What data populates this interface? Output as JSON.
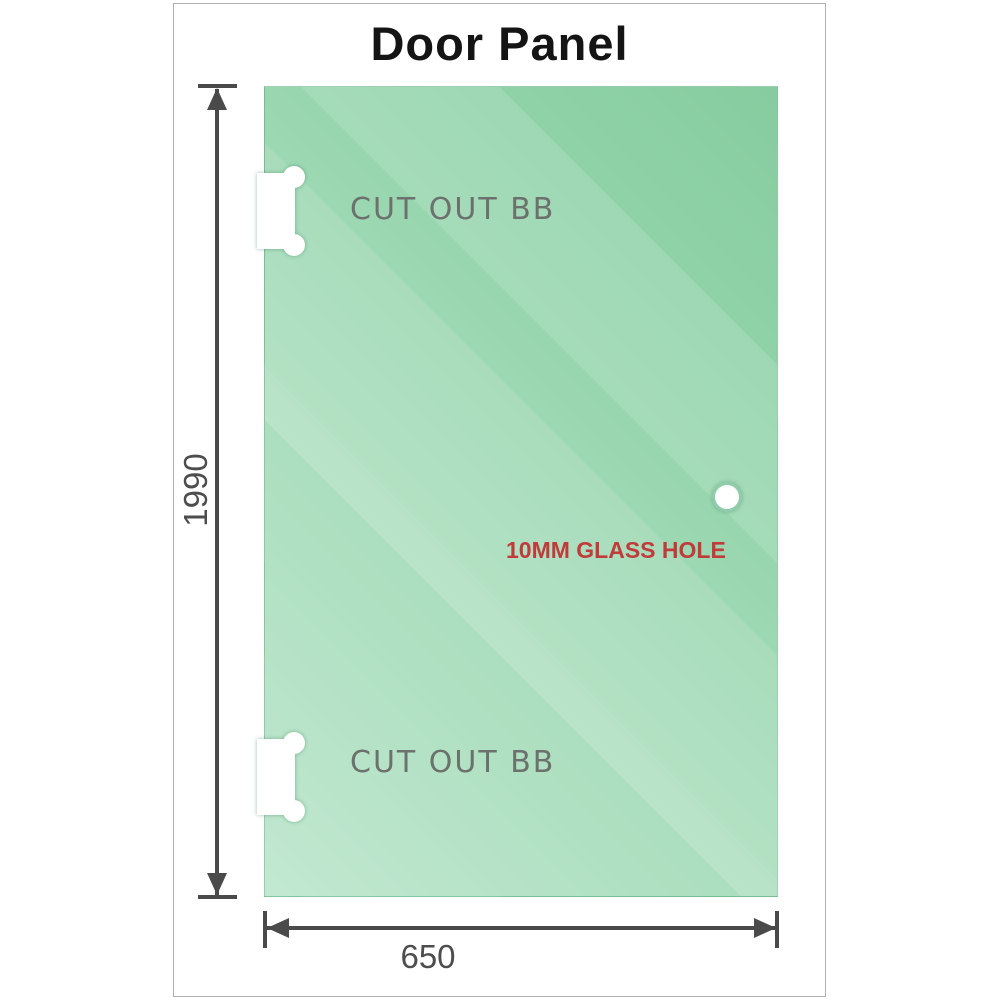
{
  "title": "Door Panel",
  "dim": {
    "height": "1990",
    "width": "650"
  },
  "labels": {
    "cutout_top": "CUT OUT BB",
    "cutout_bottom": "CUT OUT BB",
    "glass_hole": "10MM GLASS HOLE"
  },
  "icons": {
    "hinge_cutout": "white-notch-rect-with-two-round-lugs",
    "glass_hole": "white-circle-with-green-rim",
    "dimension_arrow": "css-triangle"
  },
  "colors": {
    "glass_light": "#c2e8d1",
    "glass_base": "#95d5ad",
    "glass_dark": "#86cc9f",
    "dimension_line": "#4a4a4a",
    "dimension_text": "#4d4d4d",
    "cutout_text": "#6c716d",
    "glass_hole_text": "#c13b3b",
    "hole_rim": "#8fccaa",
    "frame_border": "#b0b0b0",
    "title_text": "#141414",
    "background": "#ffffff"
  }
}
